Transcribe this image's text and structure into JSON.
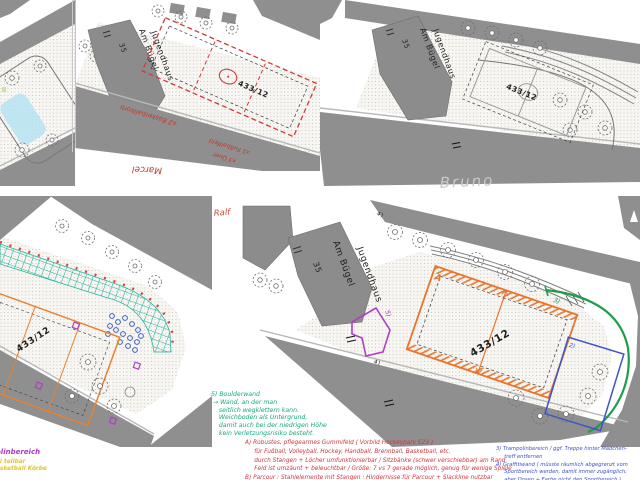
{
  "colors": {
    "road_gray": "#8f8f8f",
    "annotation_red": "#cf3540",
    "annotation_orange": "#e8742c",
    "annotation_green": "#1d9e4a",
    "annotation_teal": "#26b39e",
    "annotation_blue": "#4053c8",
    "annotation_purple": "#b03fc4",
    "annotation_yellow": "#ddc72e",
    "highlight_cyan": "#b5e3f2",
    "pencil_gray": "#c7c7c7"
  },
  "plans": {
    "top_middle": {
      "building_name_1": "Jugendhaus",
      "building_name_2": "Am Bügel",
      "house_number": "35",
      "parcel_number": "433/12",
      "red_note_1": "x2 Basketballkorb",
      "red_note_2": "x1 Fußballfeld",
      "red_note_3": "x3 Quer",
      "author": "Marcel"
    },
    "top_right": {
      "building_name_1": "Jugendhaus",
      "building_name_2": "Am Bügel",
      "house_number": "35",
      "parcel_number": "433/12",
      "author": "Bruno"
    },
    "bottom_left": {
      "parcel_number": "433/12",
      "caption_purple": "olinbereich",
      "caption_yellow_1": "al teilbar",
      "caption_yellow_2": "asketball Körbe"
    },
    "bottom_right": {
      "author": "Ralf",
      "building_name_1": "Jugendhaus",
      "building_name_2": "Am Bügel",
      "house_number": "35",
      "parcel_number": "433/12",
      "field_label": "A",
      "area_label_2": "2)",
      "area_label_3": "3)",
      "area_label_4": "4)",
      "area_label_5": "5)"
    }
  },
  "notes": {
    "green_note": "5) Boulderwand\n → Wand, an der man\n    seitlich wegklettern kann.\n    Weichboden als Untergrund,\n    damit auch bei der niedrigen Höhe\n    kein Verletzungsrisiko besteht.",
    "red_note": "A) Robustes, pflegearmes Gummifeld ( Vorbild Hockeypark E23 )\n     für Fußball, Volleyball, Hockey, Handball, Brennball, Basketball, etc.\n     durch Stangen + Löcher umfunktionierbar / Sitzbänke (schwer verschiebbar) am Rand\n     Feld ist umzäunt + beleuchtbar / Größe: 7 vs 7 gerade möglich, genug für wenige Spiele\nB) Parcour : Stahlelemente mit Stangen : Hindernisse für Parcour + Slackline nutzbar",
    "blue_note": "3) Trampolinbereich / ggf. Treppe hinter Mädchen-\n     treff entfernen\n4) Graffitiwand ( müsste räumlich abgegrenzt vom\n     Sportbereich werden, damit immer zugänglich,\n     aber Dosen + Farbe nicht den Sportbereich )"
  }
}
